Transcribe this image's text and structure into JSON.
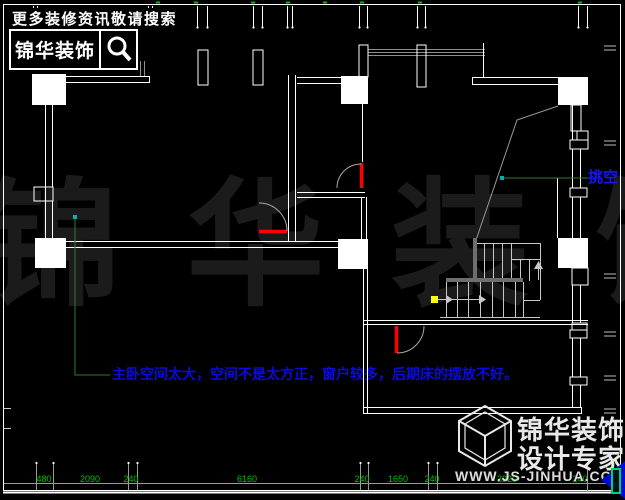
{
  "branding": {
    "top": {
      "search_hint": "更多装修资讯敬请搜索",
      "brand": "锦华装饰"
    },
    "bottom": {
      "brand": "锦华装饰",
      "slogan": "设计专家",
      "website": "WWW.JS-JINHUA.COM"
    }
  },
  "watermark": {
    "text": "锦 华 装 饰"
  },
  "annotations": {
    "bedroom_note": "主卧空间太大，空间不是太方正，窗户较多，后期床的摆放不好。",
    "void_label": "挑空"
  },
  "dimensions": {
    "bottom": [
      {
        "value": "480"
      },
      {
        "value": "2090"
      },
      {
        "value": "240"
      },
      {
        "value": "6160"
      },
      {
        "value": "240"
      },
      {
        "value": "1650"
      },
      {
        "value": "240"
      },
      {
        "value": "3920"
      },
      {
        "value": "240"
      }
    ]
  },
  "colors": {
    "background": "#000000",
    "wall_line": "#ffffff",
    "dim_green": "#00c400",
    "leader_green": "#2f7d2f",
    "annotation_blue": "#0b0bdf",
    "door_red": "#ff0000",
    "marker_yellow": "#ffff00",
    "marker_teal": "#00b0b0",
    "watermark_gray": "#1b1b1b"
  }
}
